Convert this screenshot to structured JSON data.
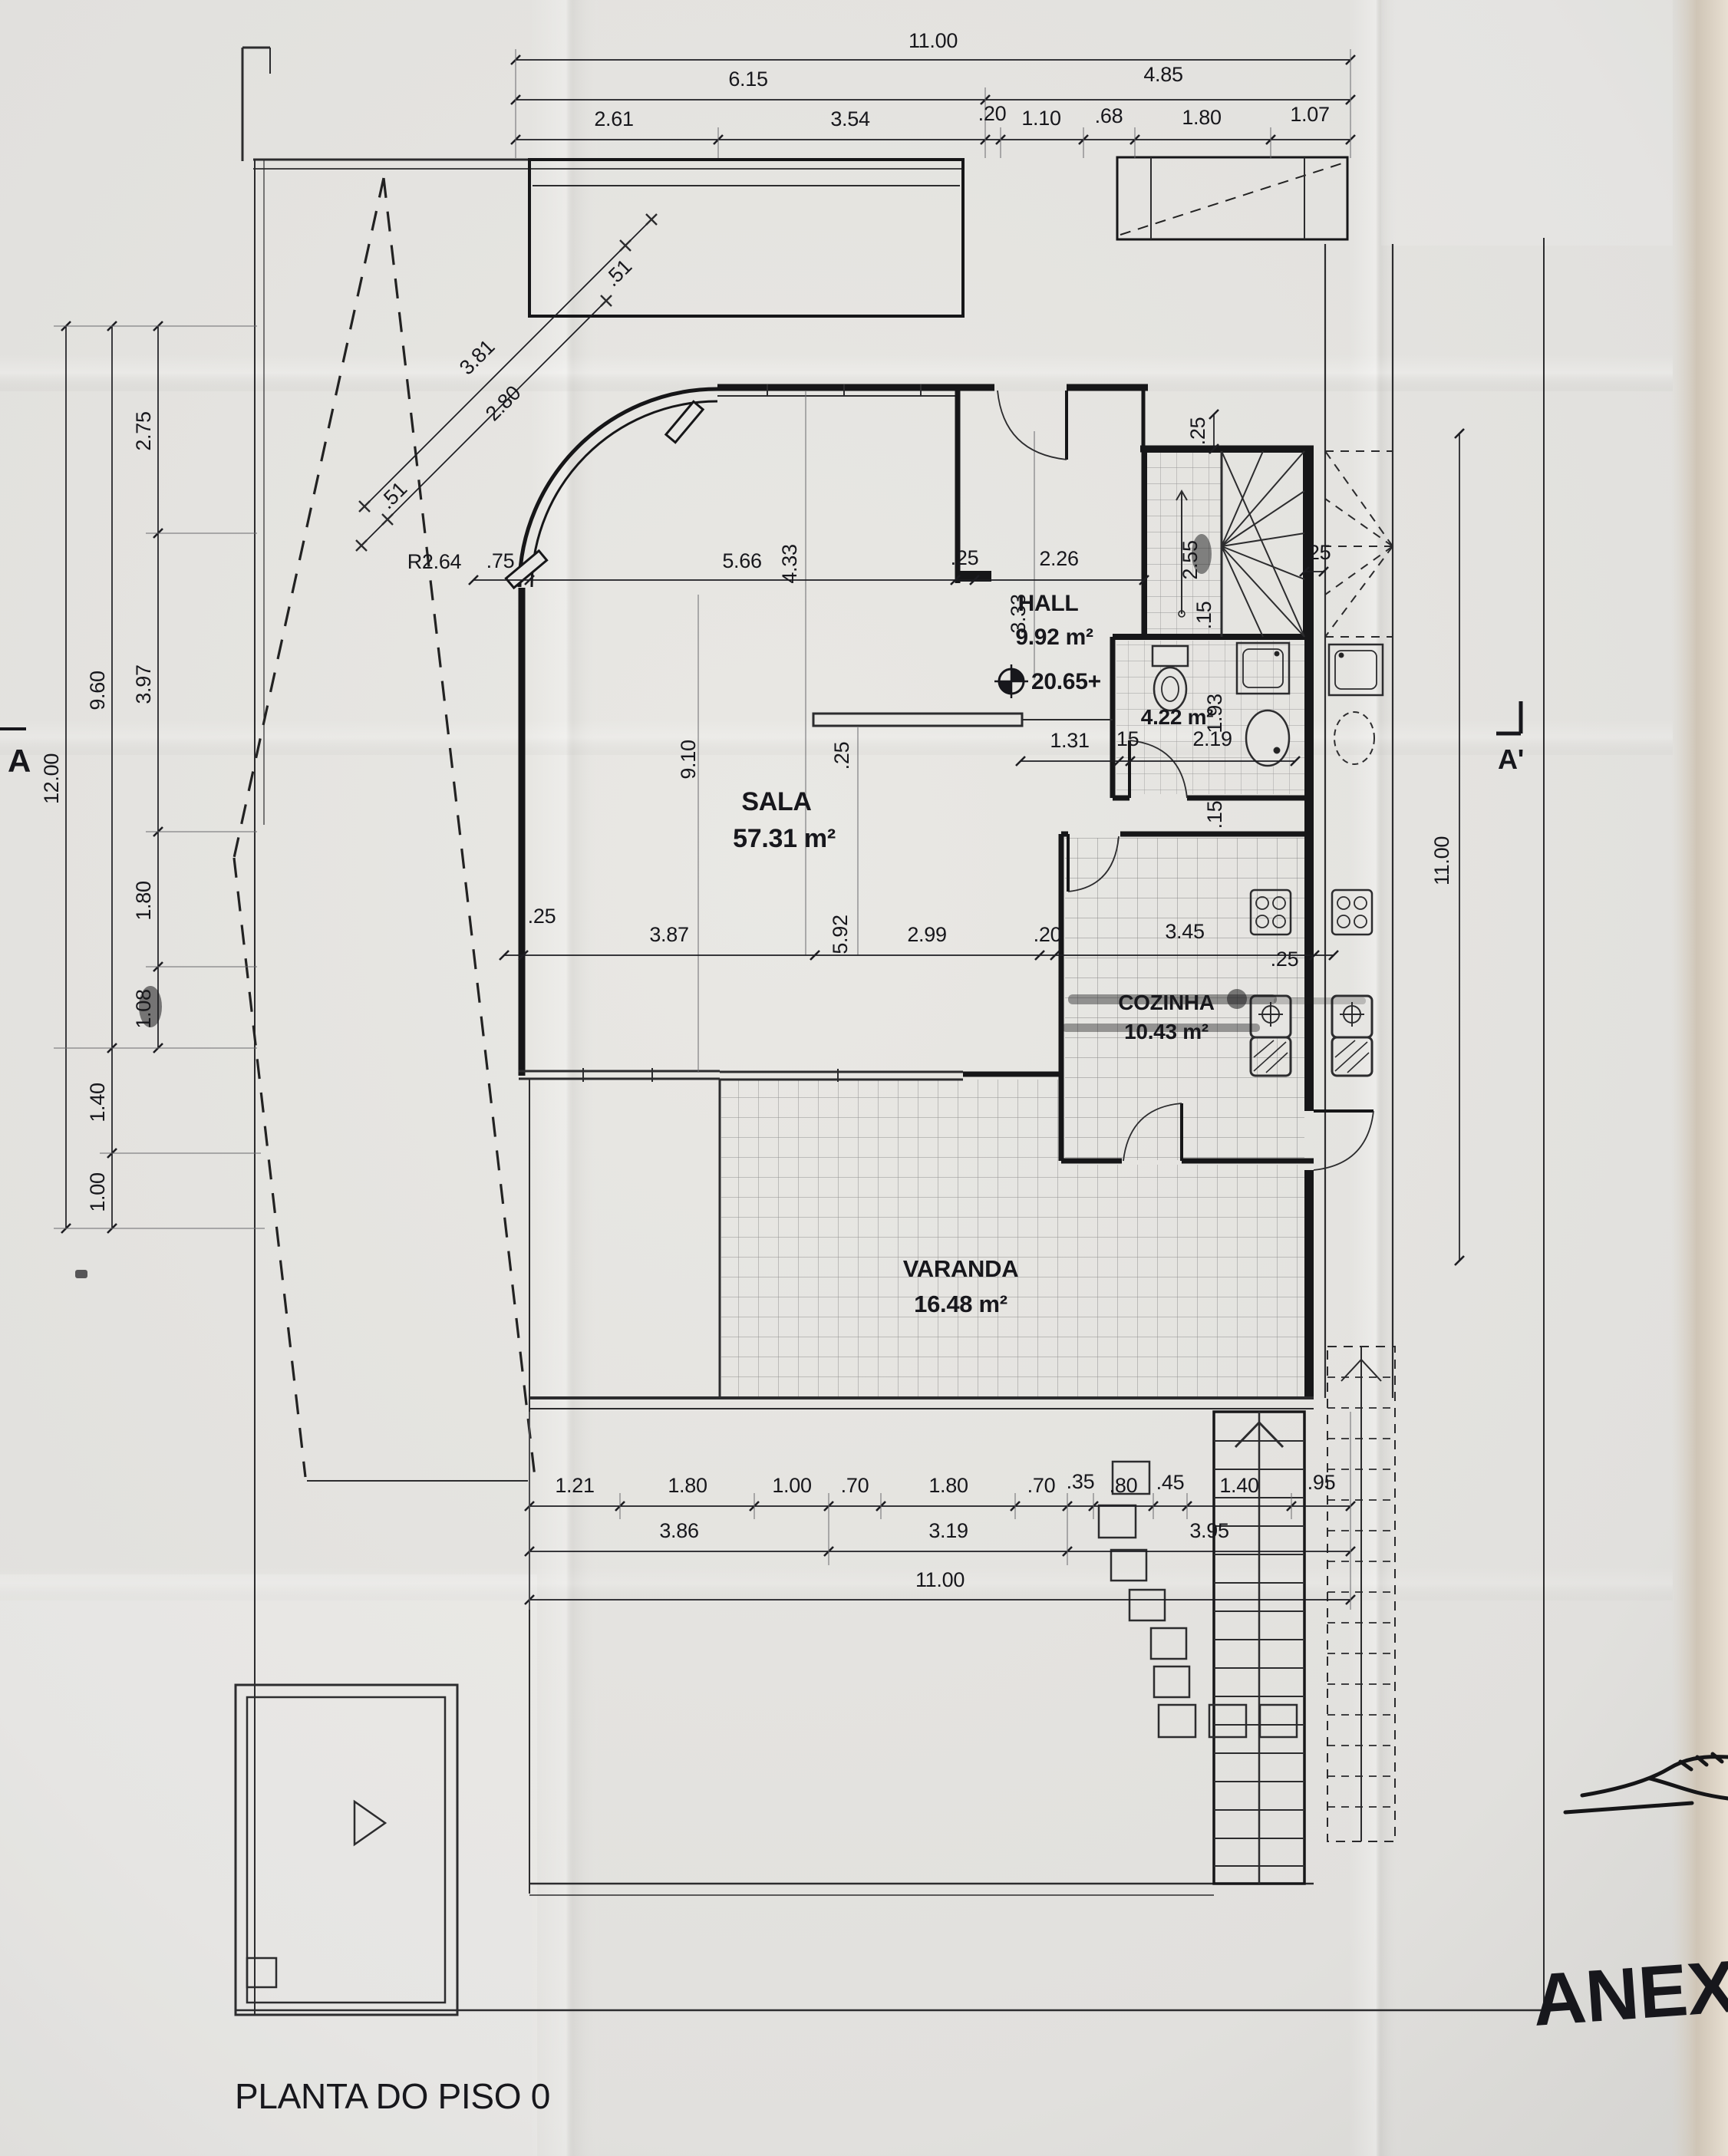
{
  "title": "PLANTA DO PISO 0",
  "handwritten_note": "ANEXO",
  "markers": {
    "section_left": "A",
    "section_right": "A'",
    "level": "20.65+",
    "radius": "R2.64"
  },
  "rooms": {
    "hall": {
      "name": "HALL",
      "area": "9.92 m²"
    },
    "sala": {
      "name": "SALA",
      "area": "57.31 m²"
    },
    "cozinha": {
      "name": "COZINHA",
      "area": "10.43 m²"
    },
    "varanda": {
      "name": "VARANDA",
      "area": "16.48 m²"
    },
    "bathroom": {
      "area": "4.22 m²"
    }
  },
  "dims": {
    "top1": "11.00",
    "top2": [
      "6.15",
      "4.85"
    ],
    "top3": [
      "2.61",
      "3.54",
      ".20",
      "1.10",
      ".68",
      "1.80",
      "1.07"
    ],
    "left_outer": "12.00",
    "left_mid": [
      "9.60",
      "1.40",
      "1.00"
    ],
    "left_inner": [
      "2.75",
      "3.97",
      "1.80",
      "1.08"
    ],
    "right": "11.00",
    "diag": [
      "3.81",
      "2.80"
    ],
    "diag_ends": [
      ".51",
      ".51"
    ],
    "row_a": [
      ".75",
      "5.66",
      ".25",
      "2.26"
    ],
    "row_a_right": ".25",
    "stair": {
      "width": "2.55",
      "tread": ".15",
      "wall": ".25",
      "top": ".25"
    },
    "vert": {
      "a": "4.33",
      "b": "3.33",
      "c": "9.10",
      "d": ".25",
      "e": "5.92"
    },
    "wc_row": [
      "1.31",
      ".15",
      "2.19"
    ],
    "wc_vert": [
      "1.93",
      ".15"
    ],
    "mid": {
      "left_wall": ".25",
      "segs": [
        "3.87",
        "2.99",
        ".20",
        "3.45"
      ],
      "right_wall": ".25"
    },
    "bottom1": [
      "1.21",
      "1.80",
      "1.00",
      ".70",
      "1.80",
      ".70",
      ".35",
      ".80",
      ".45",
      "1.40",
      ".95"
    ],
    "bottom2": [
      "3.86",
      "3.19",
      "3.95"
    ],
    "bottom3": "11.00"
  },
  "colors": {
    "paper": "#e3e2df",
    "ink": "#17171c",
    "beige_edge": "#cfc5b6"
  }
}
